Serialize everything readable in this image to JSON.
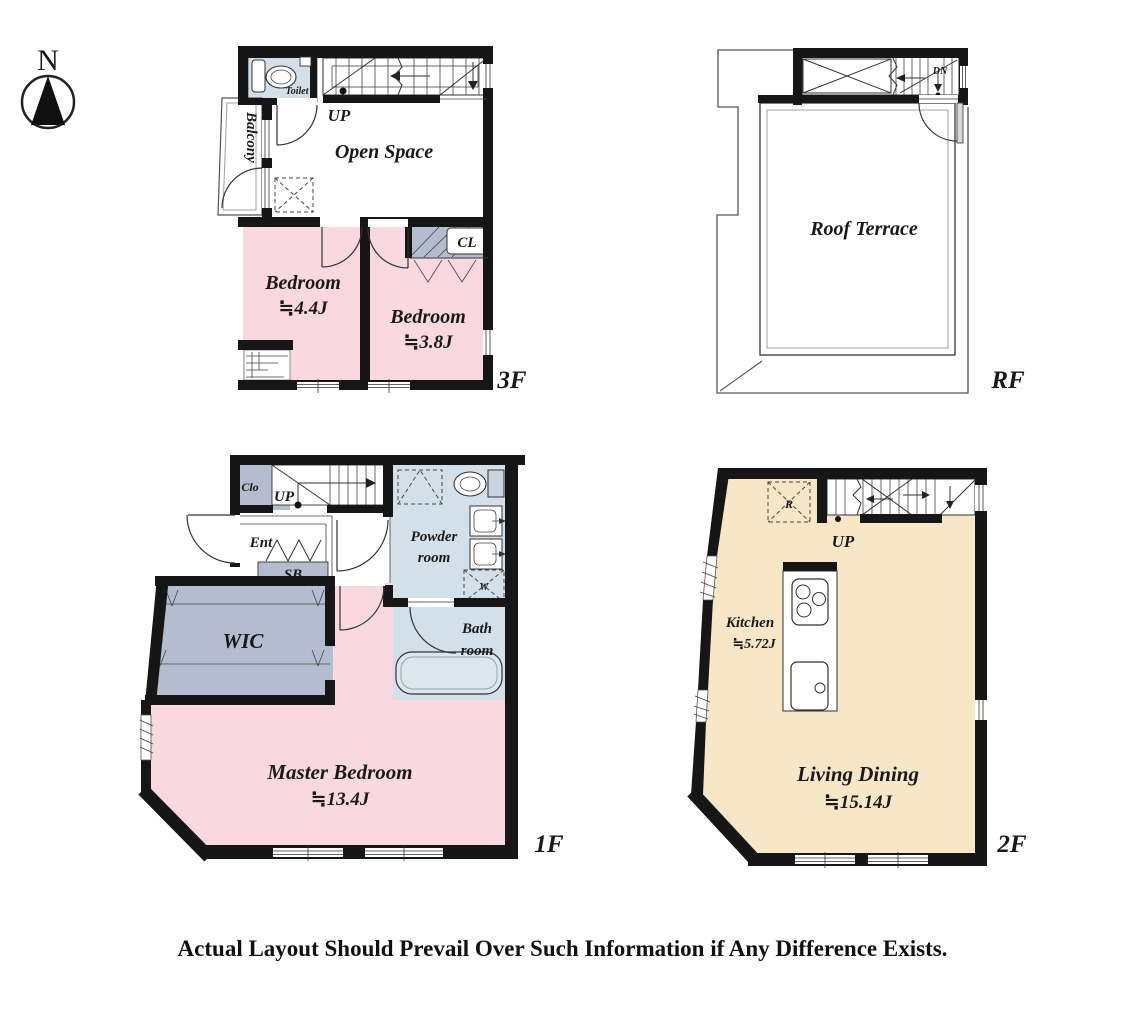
{
  "compass": {
    "north_label": "N"
  },
  "footer": {
    "disclaimer": "Actual Layout Should Prevail Over Such Information if Any Difference Exists."
  },
  "colors": {
    "wall": "#161616",
    "bedroom_pink": "#f9d9df",
    "living_cream": "#f7e7c6",
    "wet_blue": "#d3dfe9",
    "storage_gray": "#b4bccf",
    "tub_blue": "#dce6ee",
    "door_leaf_gray": "#d8d8d8"
  },
  "floor_3f": {
    "floor_label": "3F",
    "toilet_label": "Toilet",
    "balcony_label": "Balcony",
    "up_label": "UP",
    "open_space_label": "Open Space",
    "bedroom_a_name": "Bedroom",
    "bedroom_a_size": "≒4.4J",
    "bedroom_b_name": "Bedroom",
    "bedroom_b_size": "≒3.8J",
    "closet_label": "CL"
  },
  "floor_rf": {
    "floor_label": "RF",
    "down_label": "DN",
    "roof_terrace_label": "Roof Terrace"
  },
  "floor_1f": {
    "floor_label": "1F",
    "closet_label": "Clo",
    "up_label": "UP",
    "entrance_label": "Ent",
    "shoe_box_label": "SB",
    "wic_label": "WIC",
    "powder_line1": "Powder",
    "powder_line2": "room",
    "washer_label": "W",
    "bath_line1": "Bath",
    "bath_line2": "room",
    "master_name": "Master Bedroom",
    "master_size": "≒13.4J"
  },
  "floor_2f": {
    "floor_label": "2F",
    "up_label": "UP",
    "fridge_label": "R",
    "kitchen_name": "Kitchen",
    "kitchen_size": "≒5.72J",
    "living_name": "Living Dining",
    "living_size": "≒15.14J"
  }
}
